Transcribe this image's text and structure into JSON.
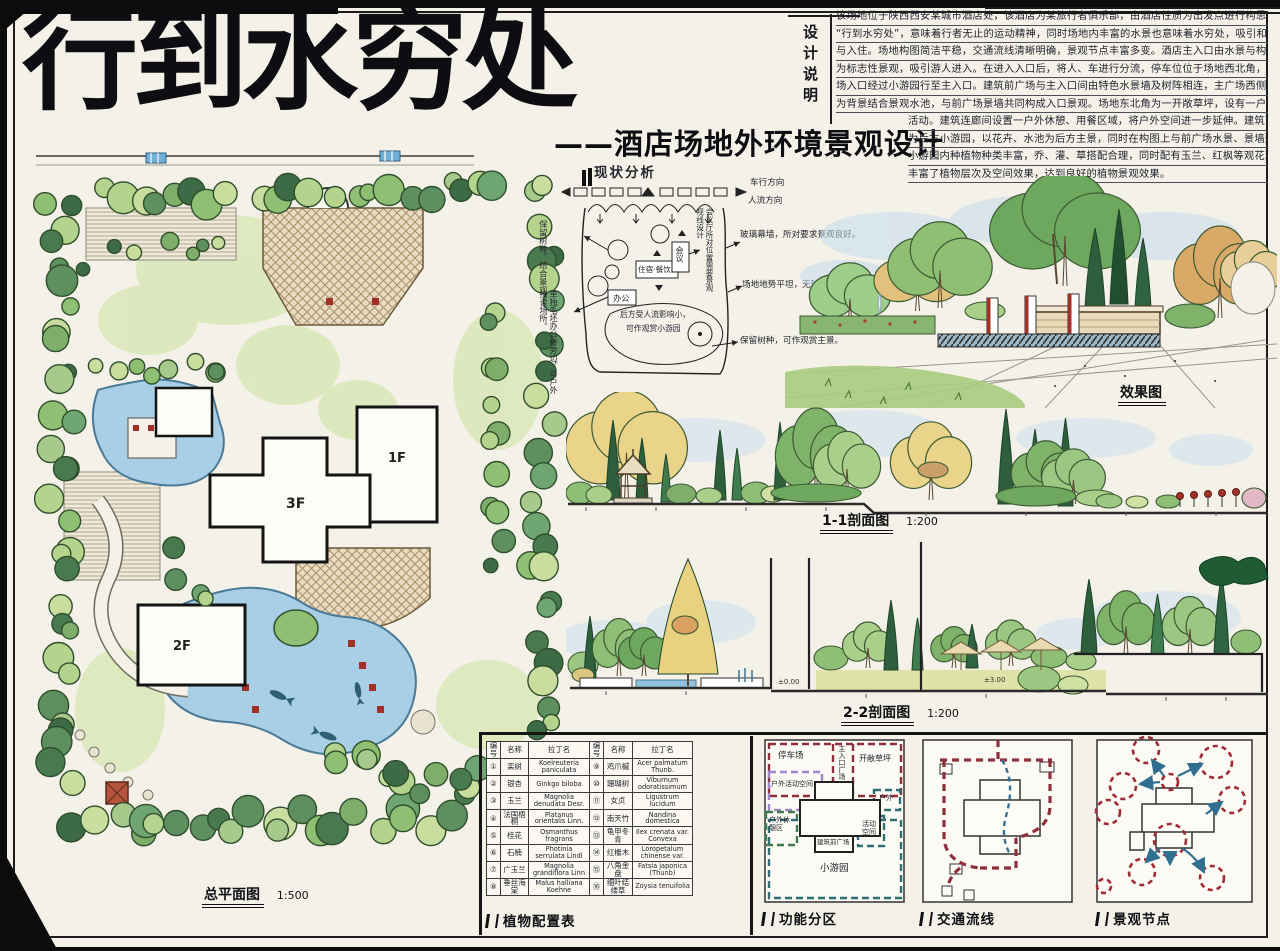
{
  "title": {
    "main": "行到水穷处",
    "subtitle": "——酒店场地外环境景观设计"
  },
  "design_notes": {
    "label": "设计说明",
    "lines": [
      "该场地位于陕西西安某城市酒店处，该酒店为某旅行者俱乐部，由酒店性质为出发点进行构思，将主题定为",
      "“行到水穷处”，意味着行者无止的运动精神，同时场地内丰富的水景也意味着水穷处，吸引和欢迎各方宾客的光临",
      "与入住。场地构图简洁平稳，交通流线清晰明确，景观节点丰富多变。酒店主入口由水景与构筑物围合作",
      "为标志性景观，吸引游人进入。在进入入口后，将人、车进行分流，停车位位于场地西北角，停车人流可由停车",
      "场入口经过小游园行至主入口。建筑前广场与主入口间由特色水景墙及树阵相连，主广场西侧以保留树种",
      "为背景结合景观水池，与前广场景墙共同构成入口景观。场地东北角为一开敞草坪，设有一户外茶亭，可举办各种",
      "活动。建筑连廊间设置一户外休憩、用餐区域，将户外空间进一步延伸。建筑南侧由入口通",
      "为后方小游园，以花卉、水池为后方主景，同时在构图上与前广场水景、景墙形成景观主轴。",
      "小游园内种植物种类丰富，乔、灌、草搭配合理，同时配有玉兰、红枫等观花观叶、色叶树种，",
      "丰富了植物层次及空间效果，达到良好的植物景观效果。"
    ]
  },
  "master_plan": {
    "caption": "总平面图",
    "scale": "1:500",
    "floors": [
      "3F",
      "1F",
      "2F"
    ]
  },
  "analysis": {
    "title": "现状分析",
    "vehicle_dir": "车行方向",
    "people_dir": "人流方向",
    "keep_trees_left": "保留树种，结合景观。",
    "office_note": "单独毛坯办公楼旁边，与户外接读场所。",
    "meeting_note": "会议厅所对位置需要景观视线设计",
    "glass_note": "玻璃幕墙，所对要求景观良好。",
    "terrain_note": "场地地势平坦，无较大起伏。",
    "keep_trees_right": "保留树种，可作观赏主景。",
    "rear_note_1": "后方受人流影响小，",
    "rear_note_2": "可作观赏小游园",
    "box_office": "办公",
    "box_lodging": "住宿·餐饮",
    "box_meeting": "会议"
  },
  "perspective": {
    "caption": "效果图"
  },
  "section_11": {
    "caption": "1-1剖面图",
    "scale": "1:200"
  },
  "section_22": {
    "caption": "2-2剖面图",
    "scale": "1:200",
    "level_a": "±0.00",
    "level_b": "±3.00"
  },
  "plant_table": {
    "caption": "植物配置表",
    "headers": [
      "编号",
      "名称",
      "拉丁名",
      "编号",
      "名称",
      "拉丁名"
    ],
    "rows": [
      [
        "①",
        "栾树",
        "Koelreuteria paniculata",
        "⑨",
        "鸡爪槭",
        "Acer palmatum Thunb."
      ],
      [
        "②",
        "银杏",
        "Ginkgo biloba",
        "⑩",
        "珊瑚树",
        "Viburnum odoratissimum"
      ],
      [
        "③",
        "玉兰",
        "Magnolia denudata Desr.",
        "⑪",
        "女贞",
        "Ligustrum lucidum"
      ],
      [
        "④",
        "法国梧桐",
        "Platanus orientalis Linn.",
        "⑫",
        "南天竹",
        "Nandina domestica"
      ],
      [
        "⑤",
        "桂花",
        "Osmanthus fragrans",
        "⑬",
        "龟甲冬青",
        "Ilex crenata var. Convexa"
      ],
      [
        "⑥",
        "石楠",
        "Photinia serrulata Lindl",
        "⑭",
        "红檵木",
        "Loropetalum chinense var."
      ],
      [
        "⑦",
        "广玉兰",
        "Magnolia grandiflora Linn",
        "⑮",
        "八角金盘",
        "Fatsia japonica (Thunb)"
      ],
      [
        "⑧",
        "垂丝海棠",
        "Malus halliana Koehne",
        "⑯",
        "细叶结缕草",
        "Zoysia tenuifolia"
      ]
    ]
  },
  "zoning": {
    "caption": "功能分区",
    "zones": {
      "parking": "停车场",
      "entry_plaza": "主入口广场",
      "lawn": "开敞草坪",
      "outdoor_activity": "户外活动空间",
      "outdoor_rest": "户外休憩区",
      "outdoor": "户外",
      "activity_space": "活动空间",
      "front_plaza": "建筑前广场",
      "garden": "小游园"
    }
  },
  "circulation": {
    "caption": "交通流线"
  },
  "nodes": {
    "caption": "景观节点"
  }
}
